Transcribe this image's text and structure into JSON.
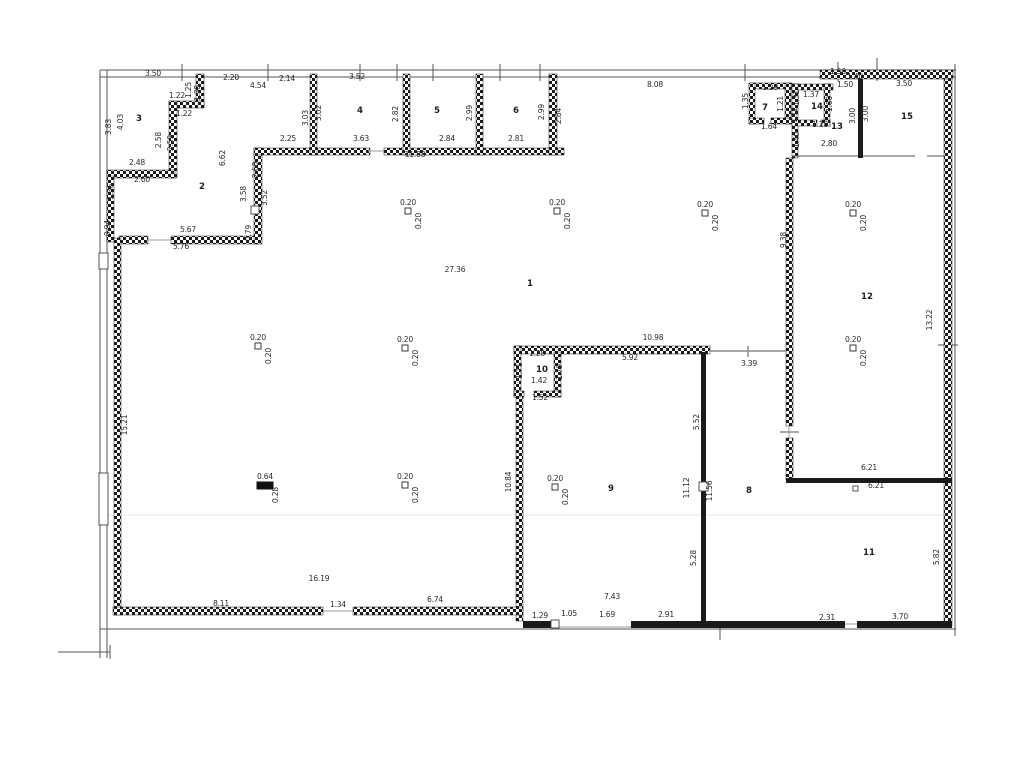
{
  "colors": {
    "wall": "#1b1b1b",
    "boundary": "#555555",
    "label": "#2b2b2b",
    "background": "#ffffff",
    "faint_line": "#e7e7e7"
  },
  "rooms": [
    {
      "n": "1",
      "x": 530,
      "y": 286
    },
    {
      "n": "2",
      "x": 202,
      "y": 189
    },
    {
      "n": "3",
      "x": 139,
      "y": 121
    },
    {
      "n": "4",
      "x": 360,
      "y": 113
    },
    {
      "n": "5",
      "x": 437,
      "y": 113
    },
    {
      "n": "6",
      "x": 516,
      "y": 113
    },
    {
      "n": "7",
      "x": 765,
      "y": 110
    },
    {
      "n": "8",
      "x": 749,
      "y": 493
    },
    {
      "n": "9",
      "x": 611,
      "y": 491
    },
    {
      "n": "10",
      "x": 542,
      "y": 372
    },
    {
      "n": "11",
      "x": 869,
      "y": 555
    },
    {
      "n": "12",
      "x": 867,
      "y": 299
    },
    {
      "n": "13",
      "x": 837,
      "y": 129
    },
    {
      "n": "14",
      "x": 817,
      "y": 109
    },
    {
      "n": "15",
      "x": 907,
      "y": 119
    }
  ],
  "dimensions": [
    {
      "t": "3.50",
      "x": 153,
      "y": 76
    },
    {
      "t": "2.20",
      "x": 231,
      "y": 80
    },
    {
      "t": "4.54",
      "x": 258,
      "y": 88
    },
    {
      "t": "2.14",
      "x": 287,
      "y": 81
    },
    {
      "t": "1.25",
      "x": 191,
      "y": 90,
      "v": 1
    },
    {
      "t": "1.38",
      "x": 200,
      "y": 93,
      "v": 1
    },
    {
      "t": "1.22",
      "x": 177,
      "y": 98
    },
    {
      "t": "1.22",
      "x": 184,
      "y": 116
    },
    {
      "t": "3.83",
      "x": 111,
      "y": 127,
      "v": 1
    },
    {
      "t": "4.03",
      "x": 123,
      "y": 122,
      "v": 1
    },
    {
      "t": "2.58",
      "x": 161,
      "y": 140,
      "v": 1
    },
    {
      "t": "2.59",
      "x": 173,
      "y": 143,
      "v": 1
    },
    {
      "t": "2.48",
      "x": 137,
      "y": 165
    },
    {
      "t": "2.60",
      "x": 142,
      "y": 182
    },
    {
      "t": "1.36",
      "x": 113,
      "y": 192,
      "v": 1
    },
    {
      "t": "0.94",
      "x": 110,
      "y": 228,
      "v": 1
    },
    {
      "t": "6.62",
      "x": 225,
      "y": 158,
      "v": 1
    },
    {
      "t": "5.67",
      "x": 188,
      "y": 232
    },
    {
      "t": "5.76",
      "x": 181,
      "y": 249
    },
    {
      "t": "0.79",
      "x": 251,
      "y": 233,
      "v": 1
    },
    {
      "t": "2.60",
      "x": 258,
      "y": 170,
      "v": 1
    },
    {
      "t": "3.58",
      "x": 246,
      "y": 194,
      "v": 1
    },
    {
      "t": "3.52",
      "x": 267,
      "y": 198,
      "v": 1
    },
    {
      "t": "3.52",
      "x": 357,
      "y": 79
    },
    {
      "t": "3.03",
      "x": 308,
      "y": 118,
      "v": 1
    },
    {
      "t": "3.02",
      "x": 321,
      "y": 113,
      "v": 1
    },
    {
      "t": "2.82",
      "x": 398,
      "y": 114,
      "v": 1
    },
    {
      "t": "2.25",
      "x": 288,
      "y": 141
    },
    {
      "t": "3.63",
      "x": 361,
      "y": 141
    },
    {
      "t": "11.88",
      "x": 415,
      "y": 157
    },
    {
      "t": "2.99",
      "x": 472,
      "y": 113,
      "v": 1
    },
    {
      "t": "2.84",
      "x": 447,
      "y": 141
    },
    {
      "t": "2.99",
      "x": 544,
      "y": 112,
      "v": 1
    },
    {
      "t": "2.84",
      "x": 561,
      "y": 116,
      "v": 1
    },
    {
      "t": "2.81",
      "x": 516,
      "y": 141
    },
    {
      "t": "8.08",
      "x": 655,
      "y": 87
    },
    {
      "t": "1.29",
      "x": 770,
      "y": 90
    },
    {
      "t": "1.35",
      "x": 748,
      "y": 101,
      "v": 1
    },
    {
      "t": "1.21",
      "x": 783,
      "y": 104,
      "v": 1
    },
    {
      "t": "1.64",
      "x": 769,
      "y": 129
    },
    {
      "t": "1.37",
      "x": 811,
      "y": 97
    },
    {
      "t": "1.31",
      "x": 799,
      "y": 98,
      "v": 1
    },
    {
      "t": "1.12",
      "x": 797,
      "y": 115,
      "v": 1
    },
    {
      "t": "1.20",
      "x": 820,
      "y": 127
    },
    {
      "t": "1.50",
      "x": 838,
      "y": 74
    },
    {
      "t": "1.40",
      "x": 855,
      "y": 79
    },
    {
      "t": "1.50",
      "x": 845,
      "y": 87
    },
    {
      "t": "1.60",
      "x": 832,
      "y": 104,
      "v": 1
    },
    {
      "t": "1.40",
      "x": 799,
      "y": 140,
      "v": 1
    },
    {
      "t": "2.80",
      "x": 829,
      "y": 146
    },
    {
      "t": "3.00",
      "x": 855,
      "y": 116,
      "v": 1
    },
    {
      "t": "3.00",
      "x": 868,
      "y": 114,
      "v": 1
    },
    {
      "t": "3.50",
      "x": 904,
      "y": 86
    },
    {
      "t": "9.38",
      "x": 786,
      "y": 240,
      "v": 1
    },
    {
      "t": "13.22",
      "x": 932,
      "y": 320,
      "v": 1
    },
    {
      "t": "27.36",
      "x": 455,
      "y": 272
    },
    {
      "t": "10.98",
      "x": 653,
      "y": 340
    },
    {
      "t": "5.92",
      "x": 630,
      "y": 360
    },
    {
      "t": "3.39",
      "x": 749,
      "y": 366
    },
    {
      "t": "1.28",
      "x": 537,
      "y": 356
    },
    {
      "t": "1.71",
      "x": 522,
      "y": 371,
      "v": 1
    },
    {
      "t": "1.79",
      "x": 562,
      "y": 372,
      "v": 1
    },
    {
      "t": "1.42",
      "x": 539,
      "y": 383
    },
    {
      "t": "1.52",
      "x": 540,
      "y": 400
    },
    {
      "t": "5.52",
      "x": 699,
      "y": 422,
      "v": 1
    },
    {
      "t": "10.84",
      "x": 511,
      "y": 482,
      "v": 1
    },
    {
      "t": "11.12",
      "x": 689,
      "y": 488,
      "v": 1
    },
    {
      "t": "11.56",
      "x": 712,
      "y": 491,
      "v": 1
    },
    {
      "t": "5.28",
      "x": 696,
      "y": 558,
      "v": 1
    },
    {
      "t": "6.21",
      "x": 869,
      "y": 470
    },
    {
      "t": "6.21",
      "x": 876,
      "y": 488
    },
    {
      "t": "5.82",
      "x": 939,
      "y": 557,
      "v": 1
    },
    {
      "t": "2.31",
      "x": 827,
      "y": 620
    },
    {
      "t": "3.70",
      "x": 900,
      "y": 619
    },
    {
      "t": "15.21",
      "x": 127,
      "y": 425,
      "v": 1
    },
    {
      "t": "16.19",
      "x": 319,
      "y": 581
    },
    {
      "t": "8.11",
      "x": 221,
      "y": 606
    },
    {
      "t": "1.34",
      "x": 338,
      "y": 607
    },
    {
      "t": "6.74",
      "x": 435,
      "y": 602
    },
    {
      "t": "7.43",
      "x": 612,
      "y": 599
    },
    {
      "t": "1.29",
      "x": 540,
      "y": 618
    },
    {
      "t": "1.05",
      "x": 569,
      "y": 616
    },
    {
      "t": "1.69",
      "x": 607,
      "y": 617
    },
    {
      "t": "2.91",
      "x": 666,
      "y": 617
    }
  ],
  "columns": [
    {
      "x": 408,
      "y": 211,
      "a": "0.20",
      "b": "0.20"
    },
    {
      "x": 557,
      "y": 211,
      "a": "0.20",
      "b": "0.20"
    },
    {
      "x": 705,
      "y": 213,
      "a": "0.20",
      "b": "0.20"
    },
    {
      "x": 853,
      "y": 213,
      "a": "0.20",
      "b": "0.20"
    },
    {
      "x": 258,
      "y": 346,
      "a": "0.20",
      "b": "0.20"
    },
    {
      "x": 405,
      "y": 348,
      "a": "0.20",
      "b": "0.20"
    },
    {
      "x": 853,
      "y": 348,
      "a": "0.20",
      "b": "0.20"
    },
    {
      "x": 265,
      "y": 485,
      "a": "0.64",
      "b": "0.28",
      "wide": 1
    },
    {
      "x": 405,
      "y": 485,
      "a": "0.20",
      "b": "0.20"
    },
    {
      "x": 555,
      "y": 487,
      "a": "0.20",
      "b": "0.20"
    }
  ]
}
